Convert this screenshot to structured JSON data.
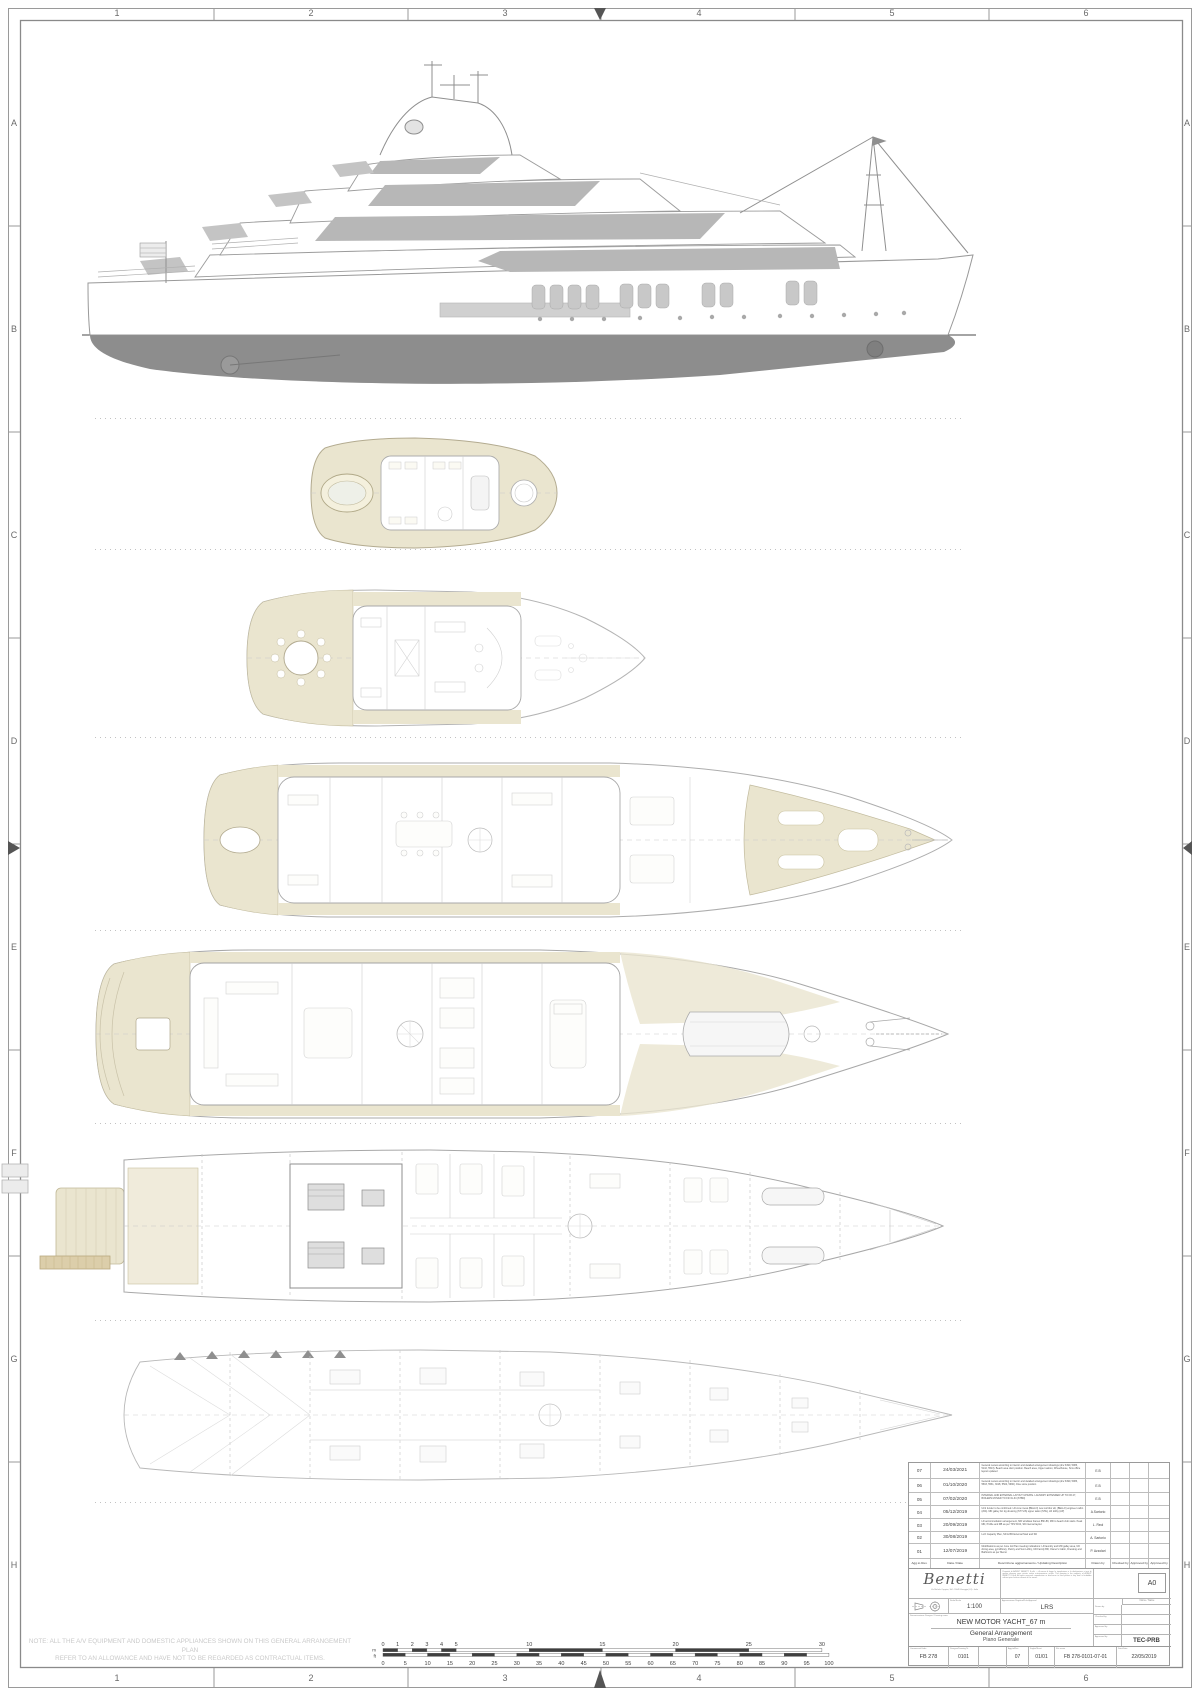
{
  "sheet": {
    "grid_columns": [
      "1",
      "2",
      "3",
      "4",
      "5",
      "6"
    ],
    "grid_rows": [
      "A",
      "B",
      "C",
      "D",
      "E",
      "F",
      "G",
      "H"
    ]
  },
  "deck_labels": [
    "Sun deck",
    "Bridge deck",
    "Upper deck",
    "Main deck",
    "Lower deck",
    "Under-Lower deck"
  ],
  "notes": {
    "external_layouts": "NOTE: EXTERNAL LAYOUTS TO BE CONFIRMED",
    "av_line1": "NOTE: ALL THE A/V EQUIPMENT AND DOMESTIC APPLIANCES SHOWN ON THIS GENERAL ARRANGEMENT PLAN",
    "av_line2": "REFER TO AN ALLOWANCE AND HAVE NOT TO BE REGARDED AS CONTRACTUAL ITEMS."
  },
  "scale_bar": {
    "unit_m": "m",
    "unit_ft": "ft",
    "meters_labels": [
      0,
      1,
      2,
      3,
      4,
      5,
      10,
      15,
      20,
      25,
      30
    ],
    "feet_labels": [
      0,
      5,
      10,
      15,
      20,
      25,
      30,
      35,
      40,
      45,
      50,
      55,
      60,
      65,
      70,
      75,
      80,
      85,
      90,
      95,
      100
    ]
  },
  "revision_table": {
    "headers": {
      "rev": "Agg.to Rev.",
      "date": "Data / Date",
      "description": "Descrizione aggiornamento / Updating Description",
      "drawn": "Drawn by",
      "checked": "Checked by",
      "approved1": "Approved by",
      "approved2": "Approved by"
    },
    "rows": [
      {
        "rev": "07",
        "date": "24/03/2021",
        "description": "General review according to interior and detailed arrangement drawings (drw 3490, 5083, 5142, 5513). Beach area door position. Beach area, Upper saloon, Wheelhouse, Sms office layout updated",
        "drawn": "E.B"
      },
      {
        "rev": "06",
        "date": "01/10/2020",
        "description": "General review according to interior and detailed arrangement drawings (drw 3490, 5083, 5503, 5531, 3018, 5504, 5990). Dive store position",
        "drawn": "E.B"
      },
      {
        "rev": "05",
        "date": "07/02/2020",
        "description": "INTERNAL AND EXTERNAL LAYOUT UPDATE. LAUNDRY EXTENDED UP TO FR.27, BOILERS MOVED TO FR.31-34 (STBD)",
        "drawn": "E.B"
      },
      {
        "rev": "04",
        "date": "05/12/2019",
        "description": "ULS fender to be confirmed. LD crew mess (BELLO) new corridor aft, (BELLO) engineer cabin (204). MD galley AC dg dressing (STYLIS) upper salon (STE), LR lobby (AP)",
        "drawn": "A.Sartorio"
      },
      {
        "rev": "03",
        "date": "20/09/2019",
        "description": "LD accommodation arrangement, MD windlass frames 85h-89, MD to beach club stairs. Peak MD, Profile and RB as per TFS 5162, SD internal layout",
        "drawn": "L. Reol"
      },
      {
        "rev": "02",
        "date": "30/08/2019",
        "description": "LLO Capacity Plan, SD & BD External Stair and SD",
        "drawn": "A. Sartorio"
      },
      {
        "rev": "01",
        "date": "12/07/2019",
        "description": "Modifications as per June 1st Plan meeting indications: LD laundry and MD galley area, UD dining area, gym/library, Pantry and Sun Lobby, UD Family BR, Owner's Cabin, Dressing and Bathroom as per Memo",
        "drawn": "P. Azzolari"
      }
    ]
  },
  "title_block": {
    "logo_text": "Benetti",
    "logo_address": "Via Michele Coppino, 104 - 55049 Viareggio (LU) - Italia",
    "legal_text": "Proprietà di AZIMUT BENETTI S.p.A. — A norma di legge la riproduzione e la divulgazione a terzi di questo disegno sono vietate senza autorizzazione scritta. This drawing is the property of AZIMUT BENETTI S.p.A. All rights reserved: reproduction or disclosure to third parties in any form is forbidden without prior written consent of the owner.",
    "format_label": "A0",
    "scale_label": "Scala/Scale",
    "scale_value": "1:100",
    "approval_label": "Approvazione Registro/Rule Approval",
    "approval_value": "LRS",
    "name_label": "Nome / Name",
    "drawn_label": "Drawn by",
    "checked_label": "Checked by",
    "approved1_label": "Approved by",
    "approved2_label": "Approved by",
    "dept_value": "TEC-PRB",
    "design_label": "Denominazione Disegno / Drawing name",
    "title_line1": "NEW MOTOR YACHT_67 m",
    "title_line2": "General Arrangement",
    "title_line3": "Piano Generale",
    "order_label": "Commessa/Order",
    "order_value": "FB 278",
    "drawing_label": "Disegno/Drawing N.",
    "drawing_value": "0101",
    "rev_label": "Agg.to/Rev.",
    "rev_value": "07",
    "sheet_label": "Foglio/Sheet",
    "sheet_value": "01/01",
    "file_label": "File name",
    "file_value": "FB 278-0101-07-01",
    "date_label": "Data/Date",
    "date_value": "22/05/2019"
  }
}
